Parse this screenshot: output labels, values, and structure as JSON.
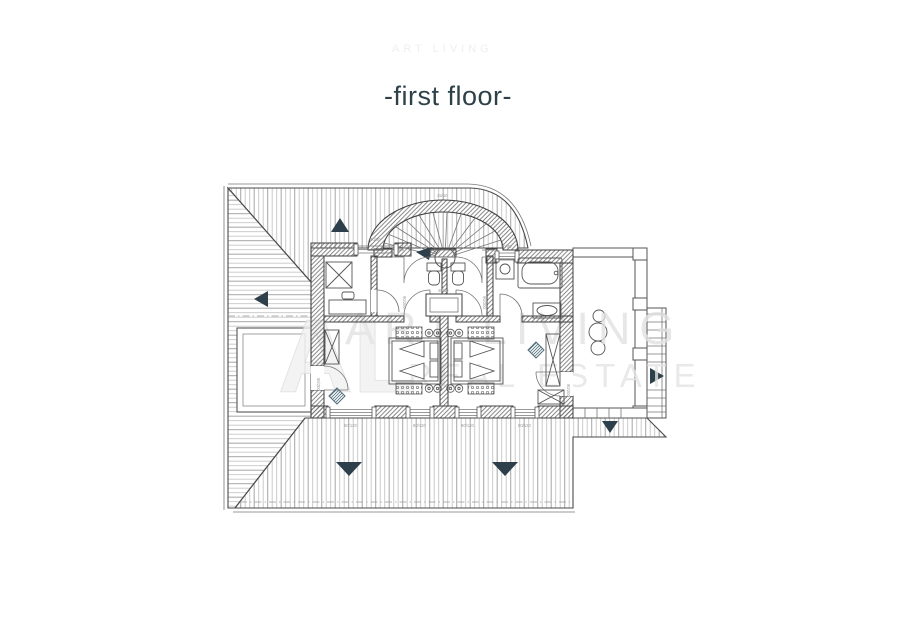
{
  "title": {
    "text": "-first floor-",
    "color": "#2e4149"
  },
  "watermark": {
    "monogram": "AL",
    "line1": "ART LIVING",
    "line2": "REAL ESTATE",
    "top_fragment": "ART LIVING",
    "color": "#e2e2e2"
  },
  "colors": {
    "ink": "#4a4a4a",
    "wall": "#3f3f3f",
    "accent": "#2d3f4a",
    "teal": "#53707c",
    "hatch": "#c6c6c6",
    "label": "#9a9a9a"
  },
  "labels": {
    "stair_width": "25/10",
    "window_top": "70/80",
    "niche": "40/60",
    "door": "90/200",
    "window_bottom": "80/120"
  }
}
